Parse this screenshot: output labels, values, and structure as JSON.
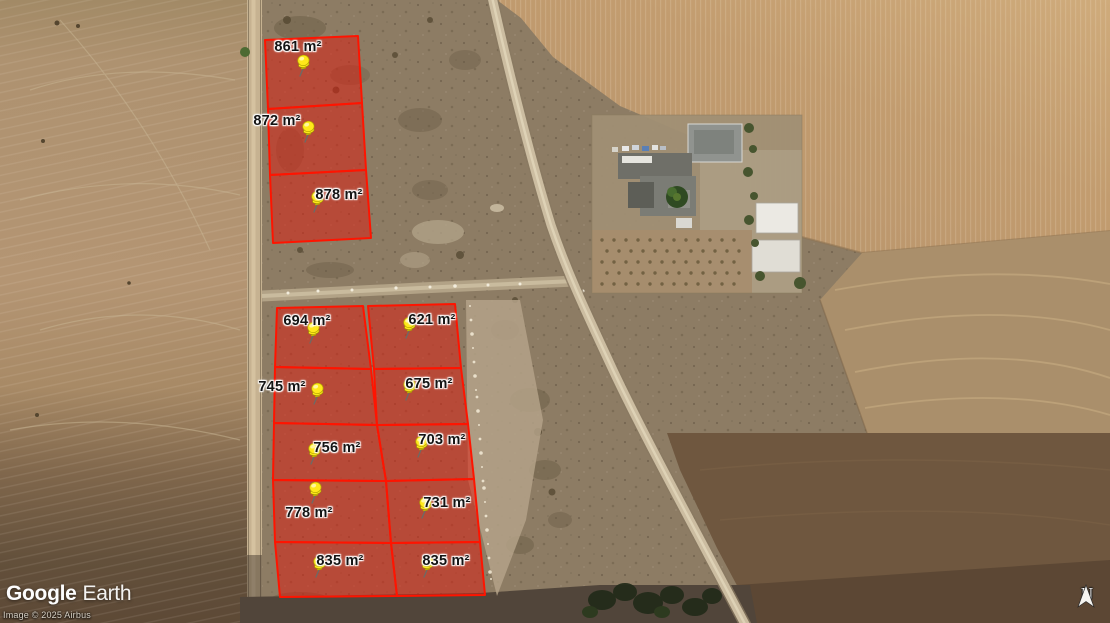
{
  "branding": {
    "google": "Google",
    "earth": "Earth",
    "attribution": "Image © 2025 Airbus"
  },
  "compass": {
    "label": "N"
  },
  "map": {
    "overlay": {
      "outline_color": "#ff1400",
      "fill_color": "rgba(222,28,15,0.52)",
      "pin_color": "#ffe81a"
    },
    "parcels": [
      {
        "name": "parcel-861",
        "area": "861 m²"
      },
      {
        "name": "parcel-872",
        "area": "872 m²"
      },
      {
        "name": "parcel-878",
        "area": "878 m²"
      },
      {
        "name": "parcel-694",
        "area": "694 m²"
      },
      {
        "name": "parcel-621",
        "area": "621 m²"
      },
      {
        "name": "parcel-745",
        "area": "745 m²"
      },
      {
        "name": "parcel-675",
        "area": "675 m²"
      },
      {
        "name": "parcel-756",
        "area": "756 m²"
      },
      {
        "name": "parcel-703",
        "area": "703 m²"
      },
      {
        "name": "parcel-778",
        "area": "778 m²"
      },
      {
        "name": "parcel-731",
        "area": "731 m²"
      },
      {
        "name": "parcel-835-left",
        "area": "835 m²"
      },
      {
        "name": "parcel-835-right",
        "area": "835 m²"
      }
    ]
  }
}
